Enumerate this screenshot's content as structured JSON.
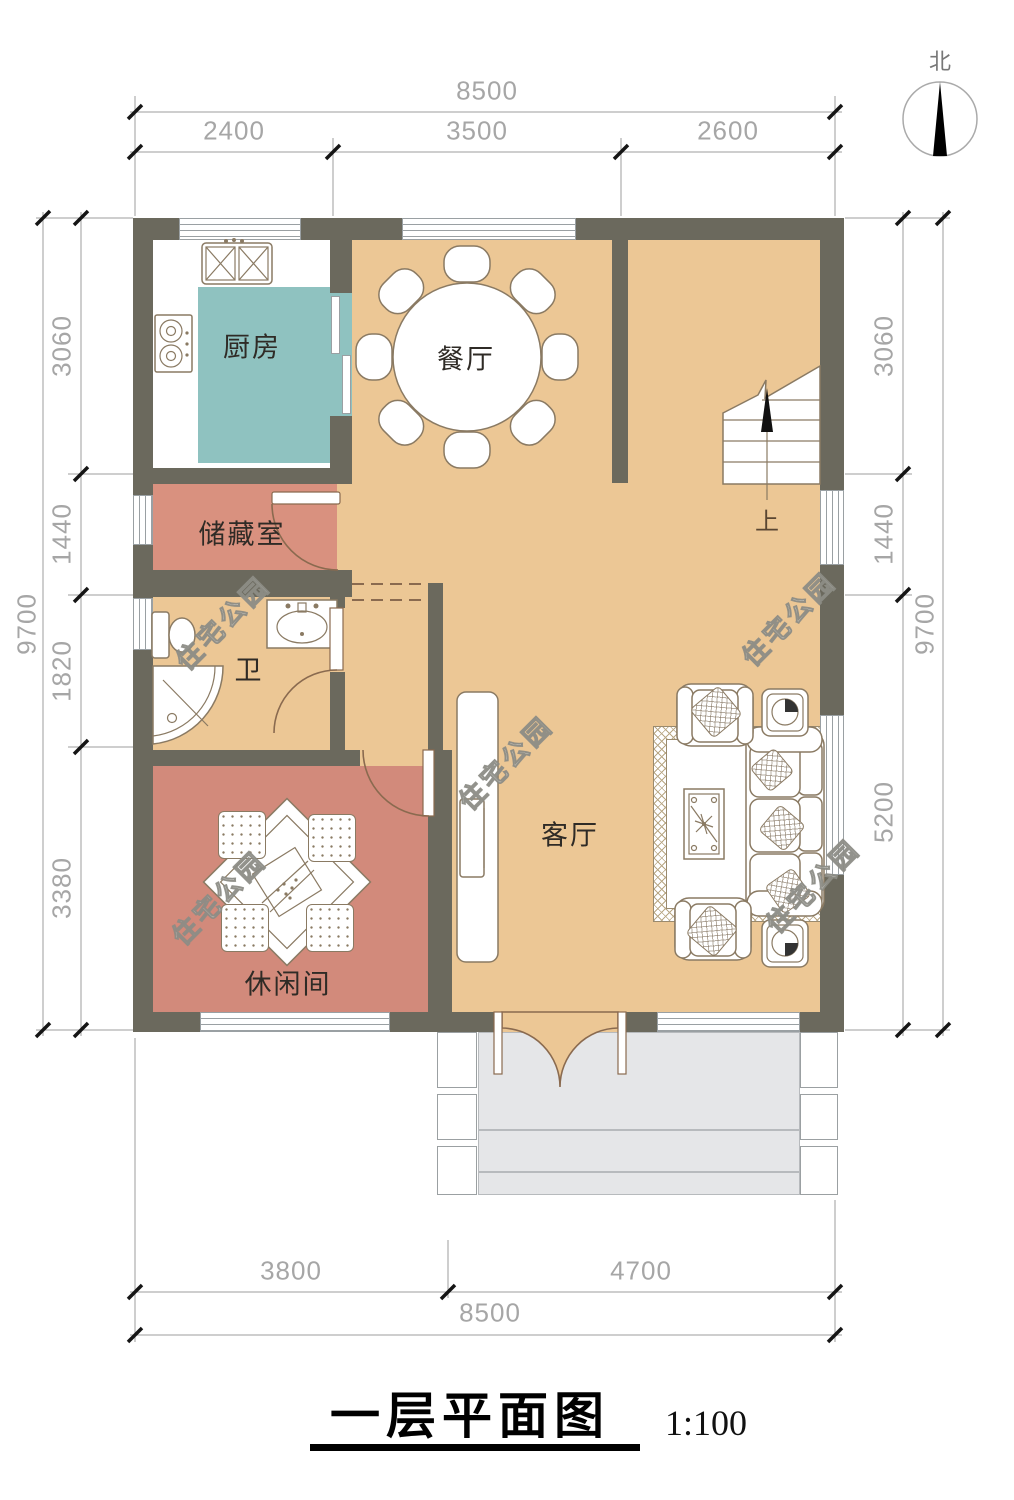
{
  "title": {
    "text": "一层平面图",
    "scale": "1:100"
  },
  "compass": {
    "label": "北"
  },
  "watermark": {
    "text": "住宅公园"
  },
  "rooms": {
    "kitchen": "厨房",
    "dining": "餐厅",
    "storage": "储藏室",
    "bathroom": "卫",
    "leisure": "休闲间",
    "living": "客厅"
  },
  "stairs": {
    "direction_label": "上"
  },
  "dimensions": {
    "top": {
      "total": "8500",
      "segments": [
        "2400",
        "3500",
        "2600"
      ]
    },
    "bottom": {
      "total": "8500",
      "segments": [
        "3800",
        "4700"
      ]
    },
    "left": {
      "total": "9700",
      "segments": [
        "3060",
        "1440",
        "1820",
        "3380"
      ]
    },
    "right": {
      "total": "9700",
      "segments": [
        "3060",
        "1440",
        "5200"
      ]
    }
  },
  "colors": {
    "wall": "#6b695d",
    "floor": "#ecc795",
    "kitchen_floor": "#8fc2c0",
    "storage_floor": "#d9917f",
    "leisure_floor": "#d28a7b",
    "porch": "#e5e6e8",
    "furniture_line": "#8a7a63",
    "door_line": "#8a6a4f",
    "dim_line": "#9e9e9e",
    "dim_text": "#a6a6a6",
    "label_text": "#2f2b26",
    "window_line": "#9aa0a3",
    "tick": "#151515"
  }
}
